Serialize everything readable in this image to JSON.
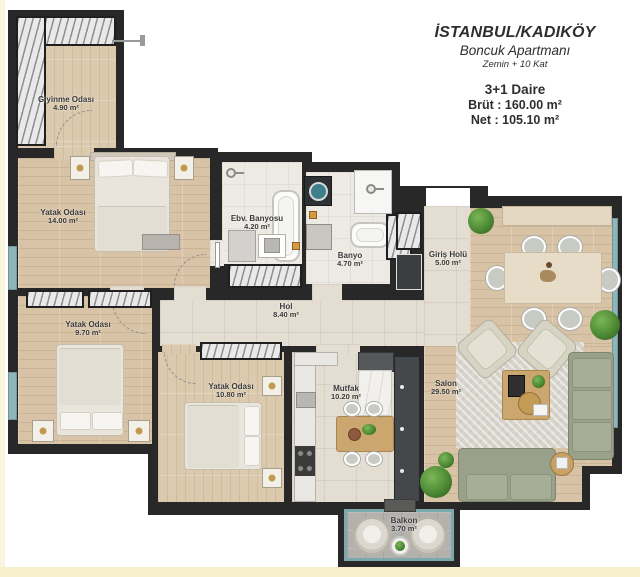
{
  "header": {
    "location": "İSTANBUL/KADIKÖY",
    "building": "Boncuk Apartmanı",
    "floors": "Zemin + 10 Kat",
    "unit_type": "3+1 Daire",
    "gross_line": "Brüt : 160.00 m²",
    "net_line": "Net : 105.10 m²"
  },
  "rooms": {
    "giyinme": {
      "name": "Giyinme Odası",
      "area": "4.90 m²"
    },
    "yatak_ebeveyn": {
      "name": "Yatak Odası",
      "area": "14.00 m²"
    },
    "ebv_banyosu": {
      "name": "Ebv. Banyosu",
      "area": "4.20 m²"
    },
    "banyo": {
      "name": "Banyo",
      "area": "4.70 m²"
    },
    "giris_holu": {
      "name": "Giriş Holü",
      "area": "5.00 m²"
    },
    "hol": {
      "name": "Hol",
      "area": "8.40 m²"
    },
    "yatak_2": {
      "name": "Yatak Odası",
      "area": "9.70 m²"
    },
    "yatak_3": {
      "name": "Yatak Odası",
      "area": "10.80 m²"
    },
    "mutfak": {
      "name": "Mutfak",
      "area": "10.20 m²"
    },
    "salon": {
      "name": "Salon",
      "area": "29.50 m²"
    },
    "balkon": {
      "name": "Balkon",
      "area": "3.70 m²"
    }
  },
  "colors": {
    "wall": "#282828",
    "wood_floor": "#d8c3a6",
    "tile_floor": "#e4ddd1",
    "window_accent": "#8fb4ba",
    "label_text": "#3a3a3a"
  }
}
